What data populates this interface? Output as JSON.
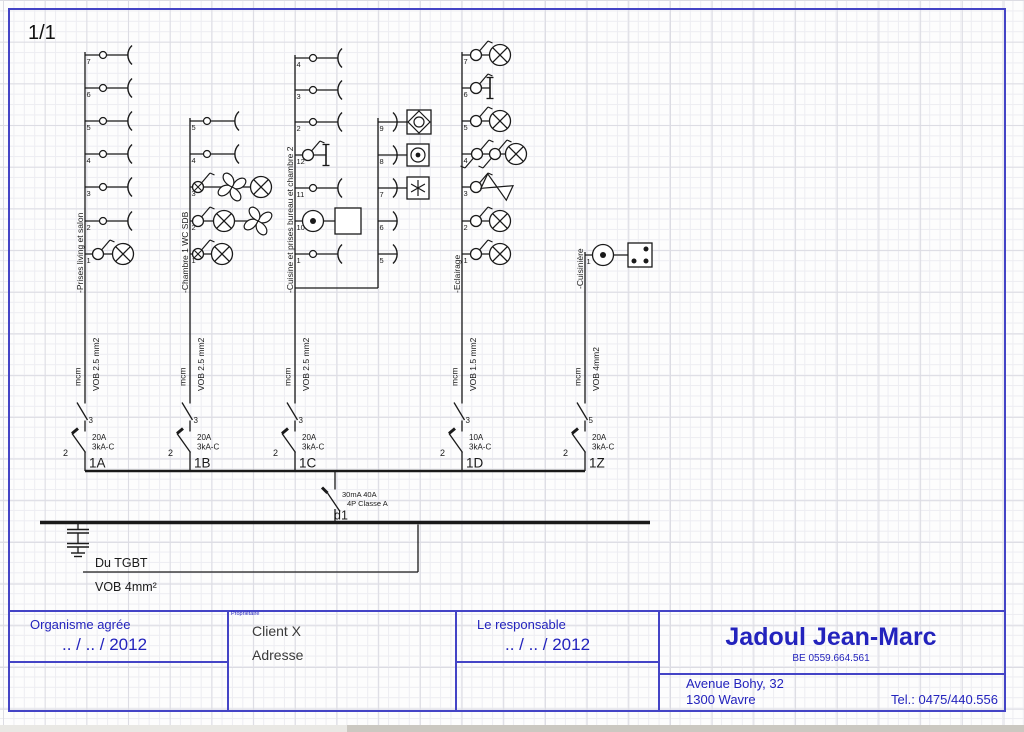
{
  "colors": {
    "ink": "#1a1a1a",
    "accent_blue": "#2323bd",
    "border_blue": "#4444c6"
  },
  "title_block": {
    "organisme": {
      "label": "Organisme agrée",
      "date": ".. / .. / 2012"
    },
    "proprietaire": {
      "label": "Propriétaire",
      "line1": "Client X",
      "line2": "Adresse"
    },
    "responsable": {
      "label": "Le responsable",
      "date": ".. / .. / 2012"
    },
    "company": {
      "name": "Jadoul Jean-Marc",
      "vat": "BE 0559.664.561",
      "address1": "Avenue Bohy, 32",
      "address2": "1300 Wavre",
      "phone": "Tel.: 0475/440.556"
    }
  },
  "schematic": {
    "page_label": "1/1",
    "bus": {
      "y": 471,
      "x1": 85,
      "x2": 585
    },
    "main_bus": {
      "y": 522.5,
      "x1": 40,
      "x2": 650
    },
    "main_switch": {
      "x": 335,
      "spec1": "30mA 40A",
      "spec2": "4P Classe A",
      "label": "d1"
    },
    "earth": {
      "x": 78
    },
    "source": {
      "label": "Du TGBT",
      "cable": "VOB 4mm²",
      "y": 572,
      "x1": 83,
      "x2": 418
    },
    "branches": [
      {
        "id": "1A",
        "x": 85,
        "top": 52,
        "dy": 293,
        "desc": "-Prises living et salon",
        "cond": "mcm",
        "cable": "VOB 2.5 mm2",
        "iso_n": "3",
        "brk_n": "2",
        "amp": "20A",
        "cut": "3kA-C",
        "circuits": [
          {
            "n": "7",
            "y": 55,
            "items": [
              {
                "t": "circle",
                "x": 103
              },
              {
                "t": "socket",
                "x": 128
              }
            ]
          },
          {
            "n": "6",
            "y": 88,
            "items": [
              {
                "t": "circle",
                "x": 103
              },
              {
                "t": "socket",
                "x": 128
              }
            ]
          },
          {
            "n": "5",
            "y": 121,
            "items": [
              {
                "t": "circle",
                "x": 103
              },
              {
                "t": "socket",
                "x": 128
              }
            ]
          },
          {
            "n": "4",
            "y": 154,
            "items": [
              {
                "t": "circle",
                "x": 103
              },
              {
                "t": "socket",
                "x": 128
              }
            ]
          },
          {
            "n": "3",
            "y": 187,
            "items": [
              {
                "t": "circle",
                "x": 103
              },
              {
                "t": "socket",
                "x": 128
              }
            ]
          },
          {
            "n": "2",
            "y": 221,
            "items": [
              {
                "t": "circle",
                "x": 103
              },
              {
                "t": "socket",
                "x": 128
              }
            ]
          },
          {
            "n": "1",
            "y": 254,
            "items": [
              {
                "t": "switch",
                "x": 98
              },
              {
                "t": "lamp",
                "x": 123
              }
            ]
          }
        ]
      },
      {
        "id": "1B",
        "x": 190,
        "top": 118,
        "dy": 293,
        "desc": "-Chambre 1 WC  SDB",
        "cond": "mcm",
        "cable": "VOB 2.5 mm2",
        "iso_n": "3",
        "brk_n": "2",
        "amp": "20A",
        "cut": "3kA-C",
        "circuits": [
          {
            "n": "5",
            "y": 121,
            "items": [
              {
                "t": "circle",
                "x": 207
              },
              {
                "t": "socket",
                "x": 235
              }
            ]
          },
          {
            "n": "4",
            "y": 154,
            "items": [
              {
                "t": "circle",
                "x": 207
              },
              {
                "t": "socket",
                "x": 235
              }
            ]
          },
          {
            "n": "3",
            "y": 187,
            "items": [
              {
                "t": "switchx",
                "x": 198
              },
              {
                "t": "fan",
                "x": 232
              },
              {
                "t": "lamp",
                "x": 261
              }
            ]
          },
          {
            "n": "2",
            "y": 221,
            "items": [
              {
                "t": "switch",
                "x": 198
              },
              {
                "t": "lamp",
                "x": 224
              },
              {
                "t": "fan",
                "x": 258
              }
            ]
          },
          {
            "n": "1",
            "y": 254,
            "items": [
              {
                "t": "switchx",
                "x": 198
              },
              {
                "t": "lamp",
                "x": 222
              }
            ]
          }
        ]
      },
      {
        "id": "1C",
        "x": 295,
        "top": 55,
        "dy": 293,
        "desc": "-Cuisine et prises bureau et chambre 2",
        "cond": "mcm",
        "cable": "VOB 2.5 mm2",
        "iso_n": "3",
        "brk_n": "2",
        "amp": "20A",
        "cut": "3kA-C",
        "circuits": [
          {
            "n": "4",
            "y": 58,
            "items": [
              {
                "t": "circle",
                "x": 313
              },
              {
                "t": "socket",
                "x": 338
              }
            ]
          },
          {
            "n": "3",
            "y": 90,
            "items": [
              {
                "t": "circle",
                "x": 313
              },
              {
                "t": "socket",
                "x": 338
              }
            ]
          },
          {
            "n": "2",
            "y": 122,
            "items": [
              {
                "t": "circle",
                "x": 313
              },
              {
                "t": "socket",
                "x": 338
              }
            ]
          },
          {
            "n": "12",
            "y": 155,
            "items": [
              {
                "t": "switch",
                "x": 308
              },
              {
                "t": "ibar",
                "x": 326
              }
            ]
          },
          {
            "n": "11",
            "y": 188,
            "items": [
              {
                "t": "circle",
                "x": 313
              },
              {
                "t": "socket",
                "x": 338
              }
            ]
          },
          {
            "n": "10",
            "y": 221,
            "items": [
              {
                "t": "motor",
                "x": 313
              },
              {
                "t": "box",
                "x": 348
              }
            ]
          },
          {
            "n": "1",
            "y": 254,
            "items": [
              {
                "t": "circle",
                "x": 313
              },
              {
                "t": "socket",
                "x": 338
              }
            ]
          }
        ],
        "sub": {
          "x": 378,
          "hy": 288,
          "top": 118,
          "circuits": [
            {
              "n": "9",
              "y": 122,
              "items": [
                {
                  "t": "socket2",
                  "x": 397
                },
                {
                  "t": "box_diamond",
                  "x": 419
                }
              ]
            },
            {
              "n": "8",
              "y": 155,
              "items": [
                {
                  "t": "socket2",
                  "x": 397
                },
                {
                  "t": "box_circle",
                  "x": 418
                }
              ]
            },
            {
              "n": "7",
              "y": 188,
              "items": [
                {
                  "t": "socket2",
                  "x": 397
                },
                {
                  "t": "box_star",
                  "x": 418
                }
              ]
            },
            {
              "n": "6",
              "y": 221,
              "items": [
                {
                  "t": "socket2",
                  "x": 397
                }
              ]
            },
            {
              "n": "5",
              "y": 254,
              "items": [
                {
                  "t": "socket2",
                  "x": 397
                }
              ]
            }
          ]
        }
      },
      {
        "id": "1D",
        "x": 462,
        "top": 52,
        "dy": 293,
        "desc": "-Eclairage",
        "cond": "mcm",
        "cable": "VOB 1.5 mm2",
        "iso_n": "3",
        "brk_n": "2",
        "amp": "10A",
        "cut": "3kA-C",
        "circuits": [
          {
            "n": "7",
            "y": 55,
            "items": [
              {
                "t": "switch",
                "x": 476
              },
              {
                "t": "lamp",
                "x": 500
              }
            ]
          },
          {
            "n": "6",
            "y": 88,
            "items": [
              {
                "t": "switch",
                "x": 476
              },
              {
                "t": "ibar",
                "x": 490
              }
            ]
          },
          {
            "n": "5",
            "y": 121,
            "items": [
              {
                "t": "switch",
                "x": 476
              },
              {
                "t": "lamp",
                "x": 500
              }
            ]
          },
          {
            "n": "4",
            "y": 154,
            "items": [
              {
                "t": "switch2",
                "x": 477
              },
              {
                "t": "switch2",
                "x": 495
              },
              {
                "t": "lamp",
                "x": 516
              }
            ]
          },
          {
            "n": "3",
            "y": 187,
            "items": [
              {
                "t": "switch",
                "x": 476
              },
              {
                "t": "bowtie",
                "x": 497
              }
            ]
          },
          {
            "n": "2",
            "y": 221,
            "items": [
              {
                "t": "switch",
                "x": 476
              },
              {
                "t": "lamp",
                "x": 500
              }
            ]
          },
          {
            "n": "1",
            "y": 254,
            "items": [
              {
                "t": "switch",
                "x": 476
              },
              {
                "t": "lamp",
                "x": 500
              }
            ]
          }
        ]
      },
      {
        "id": "1Z",
        "x": 585,
        "top": 252,
        "dy": 289,
        "desc": "-Cuisinière",
        "cond": "mcm",
        "cable": "VOB 4mm2",
        "iso_n": "5",
        "brk_n": "2",
        "amp": "20A",
        "cut": "3kA-C",
        "circuits": [
          {
            "n": "1",
            "y": 255,
            "items": [
              {
                "t": "motor",
                "x": 603
              },
              {
                "t": "box_dots",
                "x": 640
              }
            ]
          }
        ]
      }
    ]
  }
}
